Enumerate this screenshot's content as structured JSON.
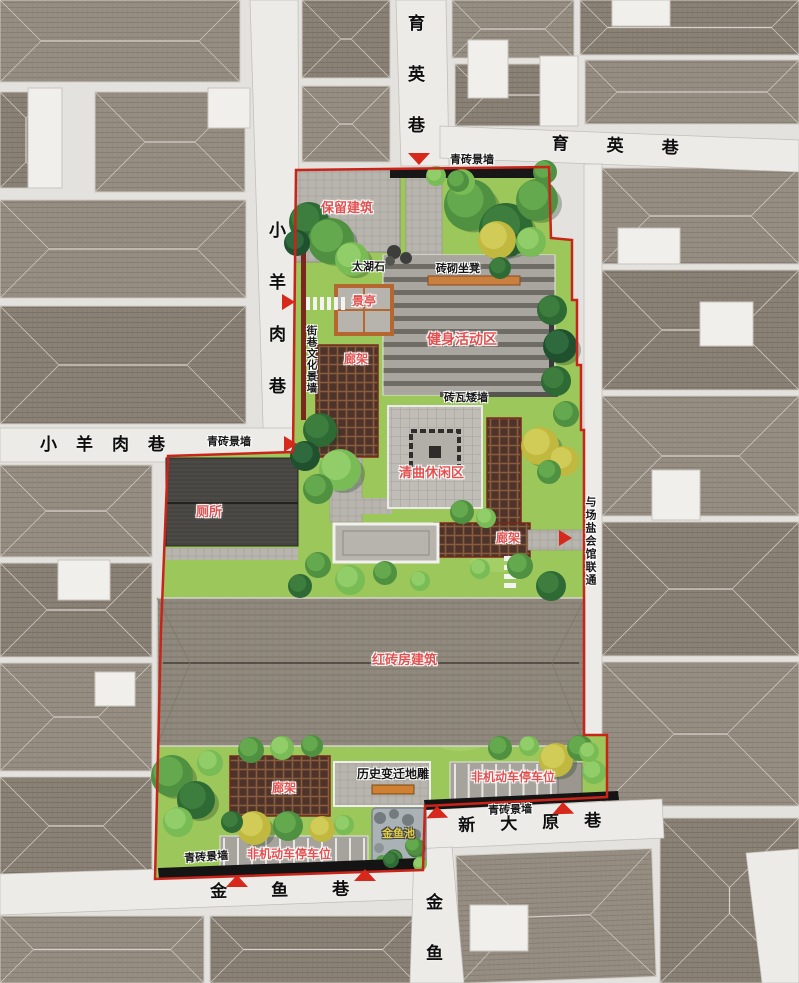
{
  "plan": {
    "type": "landscape-master-plan",
    "district_streets": [
      "育英巷",
      "小羊肉巷",
      "新大原巷",
      "金鱼巷",
      "金鱼"
    ],
    "functional_zones": [
      "保留建筑",
      "健身活动区",
      "清曲休闲区",
      "红砖房建筑",
      "非机动车停车位"
    ]
  },
  "palette": {
    "boundary_red": "#c9241a",
    "arrow_red": "#d7281c",
    "label_red": "#e25050",
    "label_yellow": "#e2cf48",
    "lawn_green": "#9cc75a",
    "road_gray": "#ecebe8",
    "roof_gray": "#968e83",
    "dark_roof": "#4f4c48",
    "pave_gray": "#b8b5af",
    "trellis_brown": "#4e332a",
    "pond_gray": "#aab2b6"
  },
  "labels": [
    {
      "name": "street-yuying-vertical",
      "text": "育英巷",
      "x": 406,
      "y": 14,
      "fs": 17,
      "kind": "street",
      "vertical": true,
      "ls": 34
    },
    {
      "name": "street-yuying-horizontal",
      "text": "育英巷",
      "x": 552,
      "y": 135,
      "fs": 17,
      "kind": "street",
      "ls": 38,
      "rot": 2
    },
    {
      "name": "street-xiaoyangrou-vertical",
      "text": "小羊肉巷",
      "x": 267,
      "y": 221,
      "fs": 17,
      "kind": "street",
      "vertical": true,
      "ls": 35
    },
    {
      "name": "street-xiaoyangrou-horizontal",
      "text": "小羊肉巷",
      "x": 40,
      "y": 436,
      "fs": 17,
      "kind": "street",
      "ls": 19
    },
    {
      "name": "street-xindayuan",
      "text": "新大原巷",
      "x": 458,
      "y": 817,
      "fs": 17,
      "kind": "street",
      "ls": 25,
      "rot": -2
    },
    {
      "name": "street-jinyu",
      "text": "金鱼巷",
      "x": 210,
      "y": 883,
      "fs": 17,
      "kind": "street",
      "ls": 44,
      "rot": -1
    },
    {
      "name": "street-jinyu-vertical",
      "text": "金鱼",
      "x": 424,
      "y": 893,
      "fs": 17,
      "kind": "street",
      "vertical": true,
      "ls": 34
    },
    {
      "name": "wall-note-north",
      "text": "青砖景墙",
      "x": 450,
      "y": 155,
      "fs": 11,
      "kind": "black"
    },
    {
      "name": "wall-note-west",
      "text": "青砖景墙",
      "x": 207,
      "y": 437,
      "fs": 11,
      "kind": "black"
    },
    {
      "name": "wall-note-southeast",
      "text": "青砖景墙",
      "x": 488,
      "y": 806,
      "fs": 11,
      "kind": "black",
      "rot": -2
    },
    {
      "name": "wall-note-southwest",
      "text": "青砖景墙",
      "x": 184,
      "y": 854,
      "fs": 11,
      "kind": "black",
      "rot": -4
    },
    {
      "name": "label-retained-building",
      "text": "保留建筑",
      "x": 321,
      "y": 201,
      "fs": 13,
      "kind": "red"
    },
    {
      "name": "label-taihu-stone",
      "text": "太湖石",
      "x": 352,
      "y": 262,
      "fs": 11,
      "kind": "black"
    },
    {
      "name": "label-brick-bench",
      "text": "砖砌坐凳",
      "x": 436,
      "y": 264,
      "fs": 11,
      "kind": "black"
    },
    {
      "name": "label-pavilion",
      "text": "景亭",
      "x": 352,
      "y": 295,
      "fs": 12,
      "kind": "red"
    },
    {
      "name": "label-fitness-area",
      "text": "健身活动区",
      "x": 427,
      "y": 332,
      "fs": 14,
      "kind": "red"
    },
    {
      "name": "label-pergola-upper",
      "text": "廊架",
      "x": 344,
      "y": 353,
      "fs": 12,
      "kind": "red"
    },
    {
      "name": "label-culture-wall",
      "text": "街巷文化景墙",
      "x": 306,
      "y": 325,
      "fs": 10.5,
      "kind": "black",
      "vertical": true,
      "ls": 1
    },
    {
      "name": "label-low-wall",
      "text": "砖瓦矮墙",
      "x": 444,
      "y": 393,
      "fs": 11,
      "kind": "black"
    },
    {
      "name": "label-qingqu-leisure",
      "text": "清曲休闲区",
      "x": 399,
      "y": 466,
      "fs": 13,
      "kind": "red"
    },
    {
      "name": "label-toilet",
      "text": "厕所",
      "x": 196,
      "y": 505,
      "fs": 13,
      "kind": "red"
    },
    {
      "name": "label-pergola-east",
      "text": "廊架",
      "x": 496,
      "y": 532,
      "fs": 12,
      "kind": "red"
    },
    {
      "name": "label-saltguild-link",
      "text": "与场盐会馆联通",
      "x": 584,
      "y": 496,
      "fs": 11,
      "kind": "black",
      "vertical": true,
      "ls": 2
    },
    {
      "name": "label-redbrick-building",
      "text": "红砖房建筑",
      "x": 372,
      "y": 653,
      "fs": 13,
      "kind": "red"
    },
    {
      "name": "label-history-carving",
      "text": "历史变迁地雕",
      "x": 357,
      "y": 768,
      "fs": 12,
      "kind": "black"
    },
    {
      "name": "label-parking-ne",
      "text": "非机动车停车位",
      "x": 471,
      "y": 771,
      "fs": 12,
      "kind": "red"
    },
    {
      "name": "label-pergola-south",
      "text": "廊架",
      "x": 272,
      "y": 782,
      "fs": 12,
      "kind": "red"
    },
    {
      "name": "label-goldfish-pond",
      "text": "金鱼池",
      "x": 382,
      "y": 829,
      "fs": 11,
      "kind": "yellow"
    },
    {
      "name": "label-parking-sw",
      "text": "非机动车停车位",
      "x": 247,
      "y": 848,
      "fs": 12,
      "kind": "red"
    }
  ],
  "arrows": [
    {
      "name": "arrow-north-entry",
      "dir": "down",
      "x": 408,
      "y": 153
    },
    {
      "name": "arrow-west-upper-entry",
      "dir": "right",
      "x": 282,
      "y": 294
    },
    {
      "name": "arrow-west-lower-entry",
      "dir": "right",
      "x": 284,
      "y": 436
    },
    {
      "name": "arrow-east-link",
      "dir": "right",
      "x": 559,
      "y": 530
    },
    {
      "name": "arrow-xindayuan-west",
      "dir": "up",
      "x": 426,
      "y": 806,
      "rot": -2
    },
    {
      "name": "arrow-xindayuan-east",
      "dir": "up",
      "x": 552,
      "y": 802,
      "rot": -2
    },
    {
      "name": "arrow-jinyu-west",
      "dir": "up",
      "x": 226,
      "y": 875
    },
    {
      "name": "arrow-jinyu-east",
      "dir": "up",
      "x": 354,
      "y": 869
    }
  ]
}
